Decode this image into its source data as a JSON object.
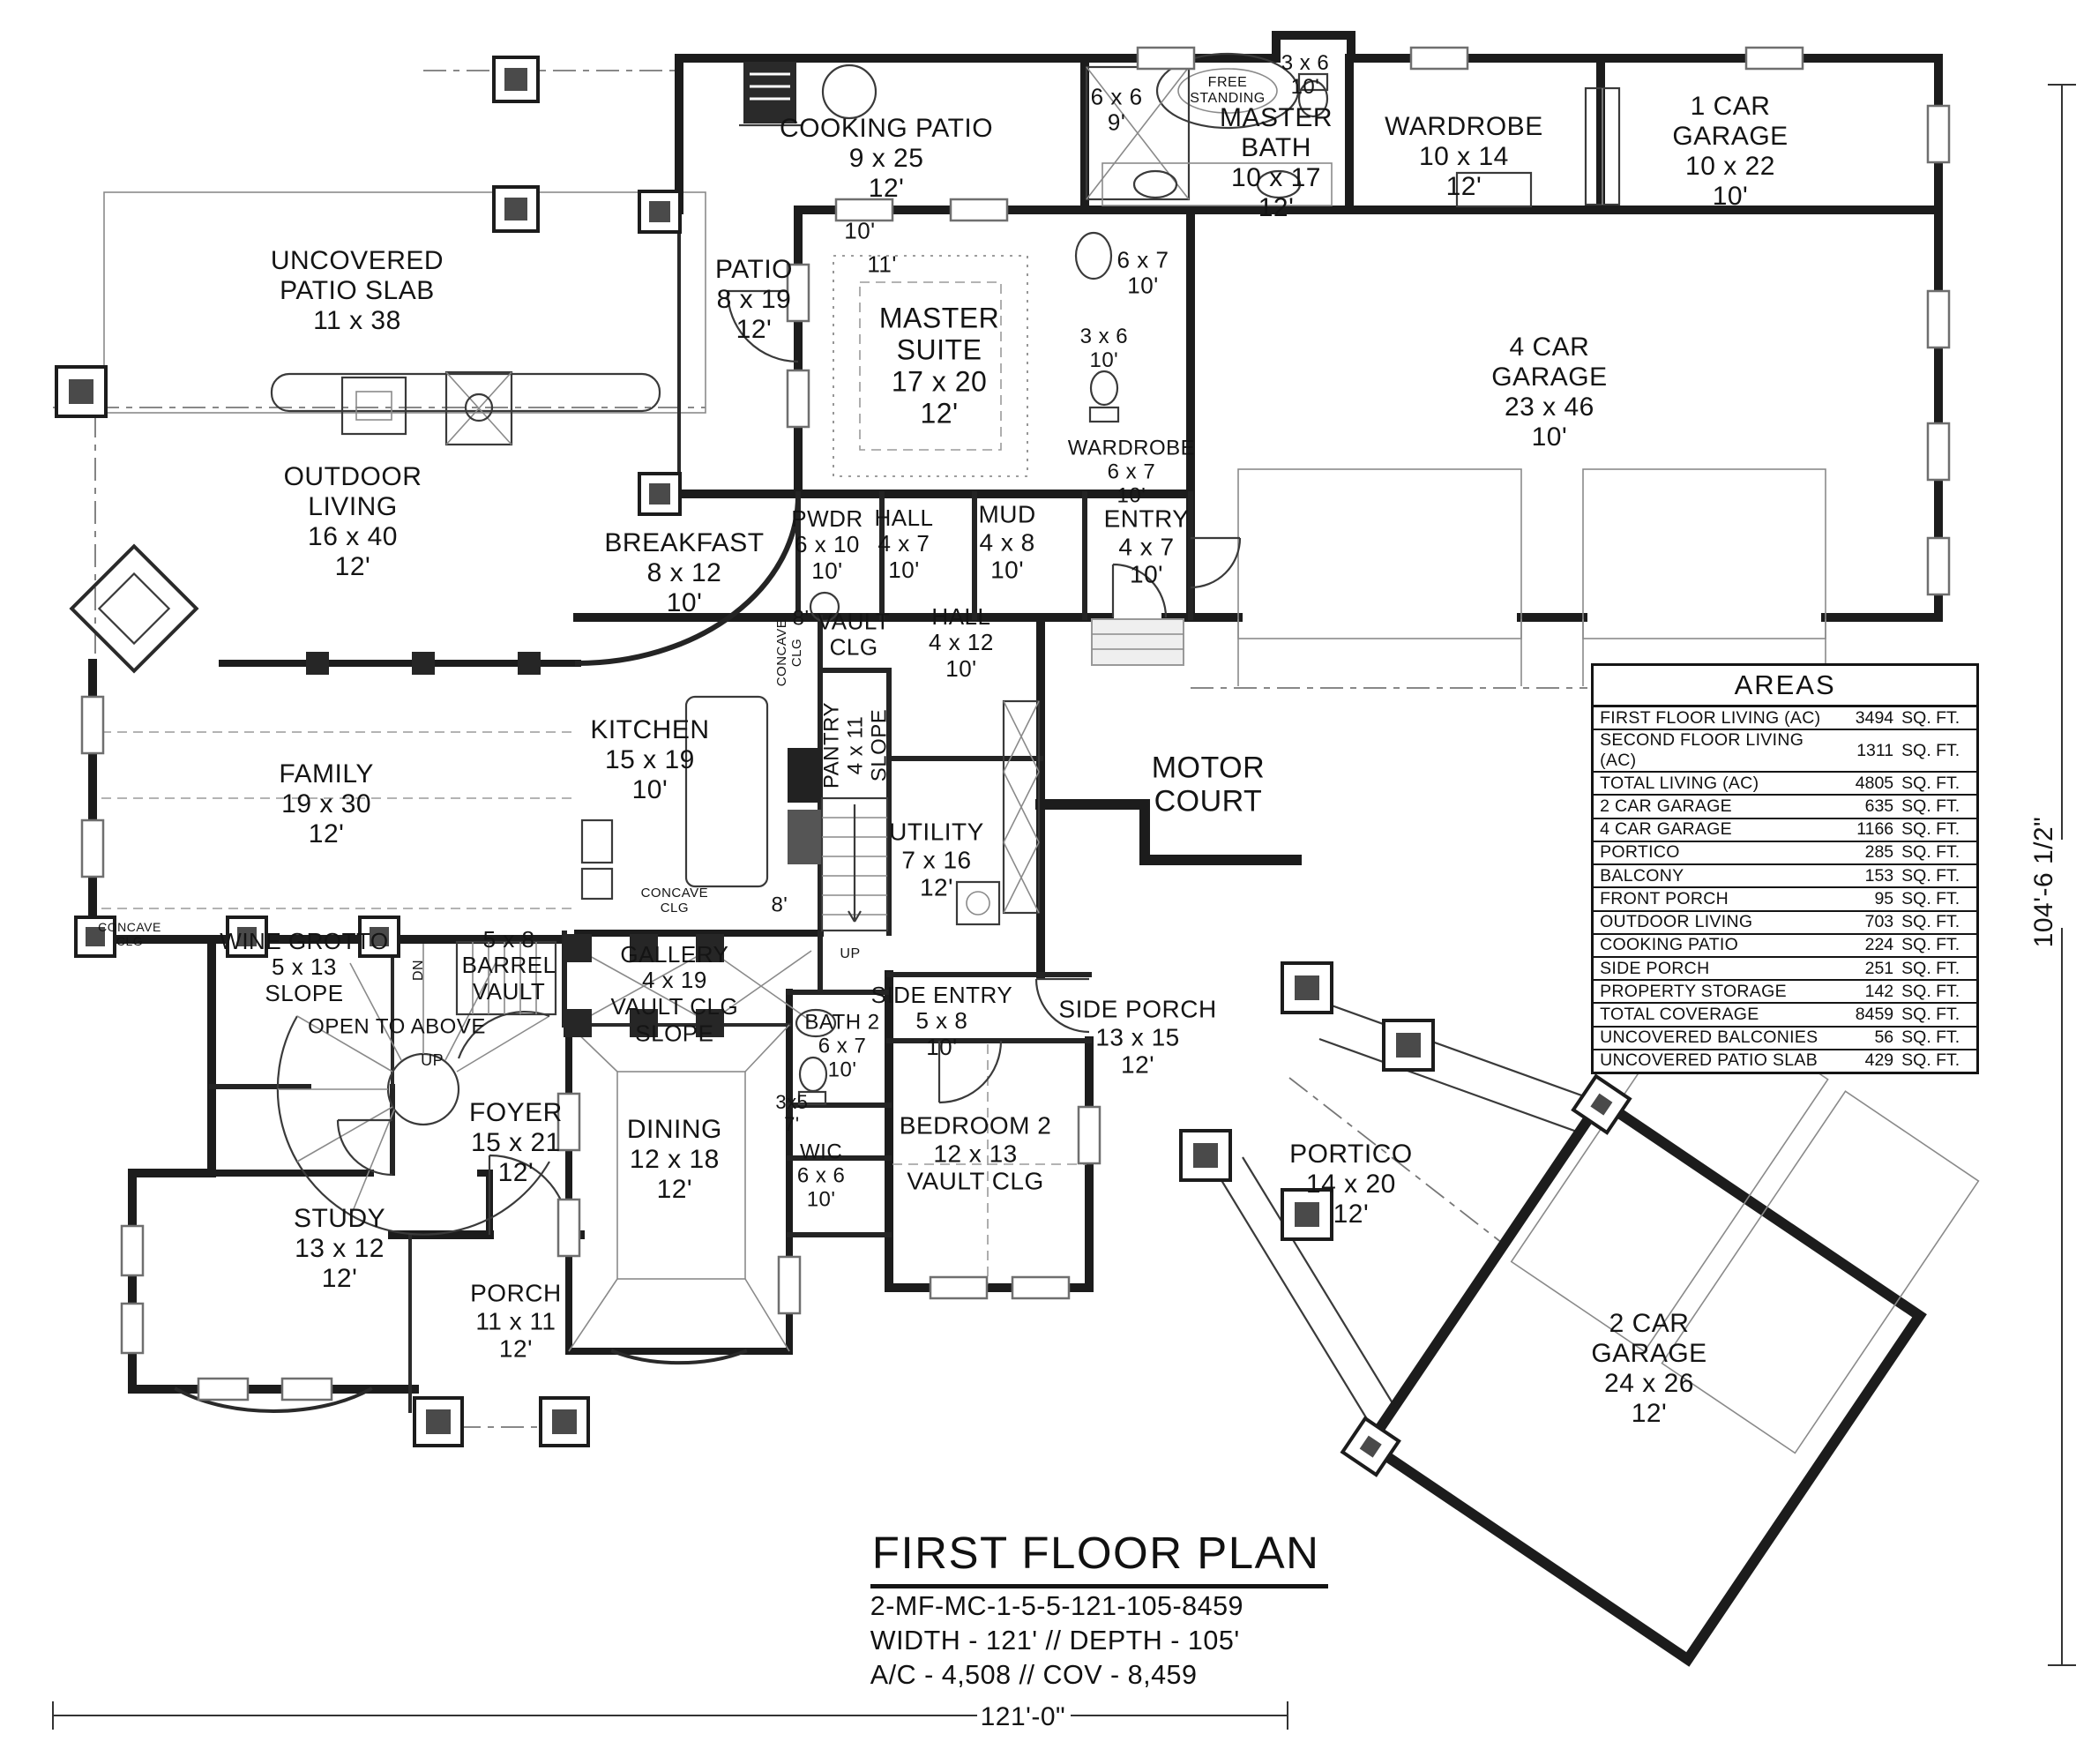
{
  "sheet": {
    "title": "FIRST FLOOR PLAN",
    "plan_code": "2-MF-MC-1-5-5-121-105-8459",
    "width_depth": "WIDTH - 121' // DEPTH - 105'",
    "ac_cov": "A/C - 4,508 // COV - 8,459"
  },
  "areas": {
    "title": "AREAS",
    "unit_suffix": "SQ. FT.",
    "rows": [
      {
        "label": "FIRST FLOOR LIVING (AC)",
        "value": "3494"
      },
      {
        "label": "SECOND FLOOR LIVING (AC)",
        "value": "1311"
      },
      {
        "label": "TOTAL LIVING (AC)",
        "value": "4805"
      },
      {
        "label": "2 CAR GARAGE",
        "value": "635"
      },
      {
        "label": "4 CAR GARAGE",
        "value": "1166"
      },
      {
        "label": "PORTICO",
        "value": "285"
      },
      {
        "label": "BALCONY",
        "value": "153"
      },
      {
        "label": "FRONT PORCH",
        "value": "95"
      },
      {
        "label": "OUTDOOR LIVING",
        "value": "703"
      },
      {
        "label": "COOKING PATIO",
        "value": "224"
      },
      {
        "label": "SIDE PORCH",
        "value": "251"
      },
      {
        "label": "PROPERTY STORAGE",
        "value": "142"
      },
      {
        "label": "TOTAL COVERAGE",
        "value": "8459"
      },
      {
        "label": "UNCOVERED BALCONIES",
        "value": "56"
      },
      {
        "label": "UNCOVERED PATIO SLAB",
        "value": "429"
      }
    ]
  },
  "labels": [
    {
      "n": "room-uncovered-patio-slab",
      "t": [
        "UNCOVERED",
        "PATIO SLAB",
        "11 x 38"
      ],
      "x": 17.08,
      "y": 16.5,
      "fs": 30
    },
    {
      "n": "room-outdoor-living",
      "t": [
        "OUTDOOR",
        "LIVING",
        "16 x 40",
        "12'"
      ],
      "x": 16.87,
      "y": 29.6,
      "fs": 30
    },
    {
      "n": "room-cooking-patio",
      "t": [
        "COOKING PATIO",
        "9 x 25",
        "12'"
      ],
      "x": 42.39,
      "y": 9.0,
      "fs": 30
    },
    {
      "n": "room-patio",
      "t": [
        "PATIO",
        "8 x 19",
        "12'"
      ],
      "x": 36.06,
      "y": 17.0,
      "fs": 30
    },
    {
      "n": "room-master-suite",
      "t": [
        "MASTER",
        "SUITE",
        "17 x 20",
        "12'"
      ],
      "x": 44.92,
      "y": 20.75,
      "fs": 32
    },
    {
      "n": "note-free-standing",
      "t": [
        "FREE",
        "STANDING"
      ],
      "x": 58.71,
      "y": 5.15,
      "fs": 16
    },
    {
      "n": "room-master-shower",
      "t": [
        "6 x 6",
        "9'"
      ],
      "x": 53.4,
      "y": 6.25,
      "fs": 26
    },
    {
      "n": "room-master-bath",
      "t": [
        "MASTER",
        "BATH",
        "10 x 17",
        "12'"
      ],
      "x": 61.03,
      "y": 9.25,
      "fs": 30
    },
    {
      "n": "room-toilet-1",
      "t": [
        "3 x 6",
        "10'"
      ],
      "x": 62.42,
      "y": 4.25,
      "fs": 24
    },
    {
      "n": "room-wardrobe-1",
      "t": [
        "WARDROBE",
        "10 x 14",
        "12'"
      ],
      "x": 70.01,
      "y": 8.9,
      "fs": 30
    },
    {
      "n": "room-1-car-garage",
      "t": [
        "1 CAR",
        "GARAGE",
        "10 x 22",
        "10'"
      ],
      "x": 82.75,
      "y": 8.6,
      "fs": 30
    },
    {
      "n": "room-4-car-garage",
      "t": [
        "4 CAR",
        "GARAGE",
        "23 x 46",
        "10'"
      ],
      "x": 74.1,
      "y": 22.25,
      "fs": 30
    },
    {
      "n": "room-linen",
      "t": [
        "6 x 7",
        "10'"
      ],
      "x": 54.66,
      "y": 15.5,
      "fs": 26
    },
    {
      "n": "room-toilet-2",
      "t": [
        "3 x 6",
        "10'"
      ],
      "x": 52.8,
      "y": 19.75,
      "fs": 24
    },
    {
      "n": "room-wardrobe-2",
      "t": [
        "WARDROBE",
        "6 x 7",
        "10'"
      ],
      "x": 54.11,
      "y": 26.75,
      "fs": 24
    },
    {
      "n": "room-entry",
      "t": [
        "ENTRY",
        "4 x 7",
        "10'"
      ],
      "x": 54.83,
      "y": 31.0,
      "fs": 28
    },
    {
      "n": "room-mud",
      "t": [
        "MUD",
        "4 x 8",
        "10'"
      ],
      "x": 48.17,
      "y": 30.75,
      "fs": 28
    },
    {
      "n": "room-hall-1",
      "t": [
        "HALL",
        "4 x 7",
        "10'"
      ],
      "x": 43.23,
      "y": 30.85,
      "fs": 26
    },
    {
      "n": "room-pwdr",
      "t": [
        "PWDR",
        "6 x 10",
        "10'"
      ],
      "x": 39.56,
      "y": 30.9,
      "fs": 26
    },
    {
      "n": "room-breakfast",
      "t": [
        "BREAKFAST",
        "8 x 12",
        "10'"
      ],
      "x": 32.73,
      "y": 32.5,
      "fs": 30
    },
    {
      "n": "room-hall-2",
      "t": [
        "HALL",
        "4 x 12",
        "10'"
      ],
      "x": 45.97,
      "y": 36.45,
      "fs": 26
    },
    {
      "n": "note-vault-clg",
      "t": [
        "VAULT",
        "CLG"
      ],
      "x": 40.83,
      "y": 36.0,
      "fs": 26
    },
    {
      "n": "note-8ft-1",
      "t": [
        "8'"
      ],
      "x": 38.3,
      "y": 35.05,
      "fs": 24
    },
    {
      "n": "note-concave-clg-1",
      "t": [
        "CONCAVE",
        "CLG"
      ],
      "x": 37.79,
      "y": 37.0,
      "fs": 15,
      "rot": -90
    },
    {
      "n": "room-kitchen",
      "t": [
        "KITCHEN",
        "15 x 19",
        "10'"
      ],
      "x": 31.08,
      "y": 43.1,
      "fs": 30
    },
    {
      "n": "room-family",
      "t": [
        "FAMILY",
        "19 x 30",
        "12'"
      ],
      "x": 15.61,
      "y": 45.6,
      "fs": 30
    },
    {
      "n": "room-pantry",
      "t": [
        "PANTRY",
        "4 x 11",
        "SLOPE"
      ],
      "x": 40.91,
      "y": 42.25,
      "fs": 24,
      "rot": -90
    },
    {
      "n": "room-utility",
      "t": [
        "UTILITY",
        "7 x 16",
        "12'"
      ],
      "x": 44.79,
      "y": 48.75,
      "fs": 28
    },
    {
      "n": "area-motor-court",
      "t": [
        "MOTOR",
        "COURT"
      ],
      "x": 57.78,
      "y": 44.5,
      "fs": 34
    },
    {
      "n": "note-concave-clg-2",
      "t": [
        "CONCAVE",
        "CLG"
      ],
      "x": 32.26,
      "y": 51.1,
      "fs": 15
    },
    {
      "n": "note-8ft-2",
      "t": [
        "8'"
      ],
      "x": 37.28,
      "y": 51.3,
      "fs": 24
    },
    {
      "n": "note-concave-clg-3",
      "t": [
        "CONCAVE",
        "CLG"
      ],
      "x": 6.2,
      "y": 53.0,
      "fs": 14
    },
    {
      "n": "room-wine-grotto",
      "t": [
        "WINE GROTTO",
        "5 x 13",
        "SLOPE"
      ],
      "x": 14.55,
      "y": 54.85,
      "fs": 26
    },
    {
      "n": "note-barrel-vault",
      "t": [
        "5 x 8",
        "BARREL",
        "VAULT"
      ],
      "x": 24.34,
      "y": 54.75,
      "fs": 26
    },
    {
      "n": "note-open-to-above",
      "t": [
        "OPEN TO ABOVE"
      ],
      "x": 18.98,
      "y": 58.2,
      "fs": 24
    },
    {
      "n": "note-up-spiral",
      "t": [
        "UP"
      ],
      "x": 20.67,
      "y": 60.1,
      "fs": 18
    },
    {
      "n": "note-dn-stair",
      "t": [
        "DN"
      ],
      "x": 20.03,
      "y": 55.0,
      "fs": 16,
      "rot": -90
    },
    {
      "n": "room-gallery",
      "t": [
        "GALLERY",
        "4 x 19",
        "VAULT CLG"
      ],
      "x": 32.26,
      "y": 55.6,
      "fs": 26
    },
    {
      "n": "note-slope-dining",
      "t": [
        "SLOPE"
      ],
      "x": 32.26,
      "y": 58.6,
      "fs": 26
    },
    {
      "n": "room-dining",
      "t": [
        "DINING",
        "12 x 18",
        "12'"
      ],
      "x": 32.26,
      "y": 65.75,
      "fs": 30
    },
    {
      "n": "room-bath-2",
      "t": [
        "BATH 2",
        "6 x 7",
        "10'"
      ],
      "x": 40.28,
      "y": 59.3,
      "fs": 24
    },
    {
      "n": "room-side-entry",
      "t": [
        "SIDE ENTRY",
        "5 x 8",
        "10'"
      ],
      "x": 45.04,
      "y": 57.9,
      "fs": 26
    },
    {
      "n": "room-closet-3x5",
      "t": [
        "3x5",
        "7'"
      ],
      "x": 37.87,
      "y": 63.15,
      "fs": 22
    },
    {
      "n": "room-wic",
      "t": [
        "WIC",
        "6 x 6",
        "10'"
      ],
      "x": 39.27,
      "y": 66.65,
      "fs": 24
    },
    {
      "n": "room-bedroom-2",
      "t": [
        "BEDROOM 2",
        "12 x 13",
        "VAULT CLG"
      ],
      "x": 46.65,
      "y": 65.4,
      "fs": 28
    },
    {
      "n": "room-side-porch",
      "t": [
        "SIDE PORCH",
        "13 x 15",
        "12'"
      ],
      "x": 54.41,
      "y": 58.8,
      "fs": 28
    },
    {
      "n": "room-portico",
      "t": [
        "PORTICO",
        "14 x 20",
        "12'"
      ],
      "x": 64.61,
      "y": 67.15,
      "fs": 30
    },
    {
      "n": "room-2-car-garage",
      "t": [
        "2 CAR",
        "GARAGE",
        "24 x 26",
        "12'"
      ],
      "x": 78.87,
      "y": 77.6,
      "fs": 30
    },
    {
      "n": "room-foyer",
      "t": [
        "FOYER",
        "15 x 21",
        "12'"
      ],
      "x": 24.67,
      "y": 64.8,
      "fs": 30
    },
    {
      "n": "room-study",
      "t": [
        "STUDY",
        "13 x 12",
        "12'"
      ],
      "x": 16.24,
      "y": 70.8,
      "fs": 30
    },
    {
      "n": "room-porch",
      "t": [
        "PORCH",
        "11 x 11",
        "12'"
      ],
      "x": 24.67,
      "y": 74.9,
      "fs": 28
    },
    {
      "n": "note-up-back-stair",
      "t": [
        "UP"
      ],
      "x": 40.66,
      "y": 54.1,
      "fs": 16
    },
    {
      "n": "note-10ft-suite",
      "t": [
        "10'"
      ],
      "x": 41.12,
      "y": 13.1,
      "fs": 26
    },
    {
      "n": "note-11ft-suite",
      "t": [
        "11'"
      ],
      "x": 42.18,
      "y": 15.0,
      "fs": 26
    },
    {
      "n": "dimension-bottom",
      "t": [
        "121'-0\""
      ],
      "x": 48.92,
      "y": 97.35,
      "fs": 30
    },
    {
      "n": "dimension-right",
      "t": [
        "104'-6 1/2\""
      ],
      "x": 97.76,
      "y": 50.0,
      "fs": 30,
      "rot": -90
    }
  ]
}
